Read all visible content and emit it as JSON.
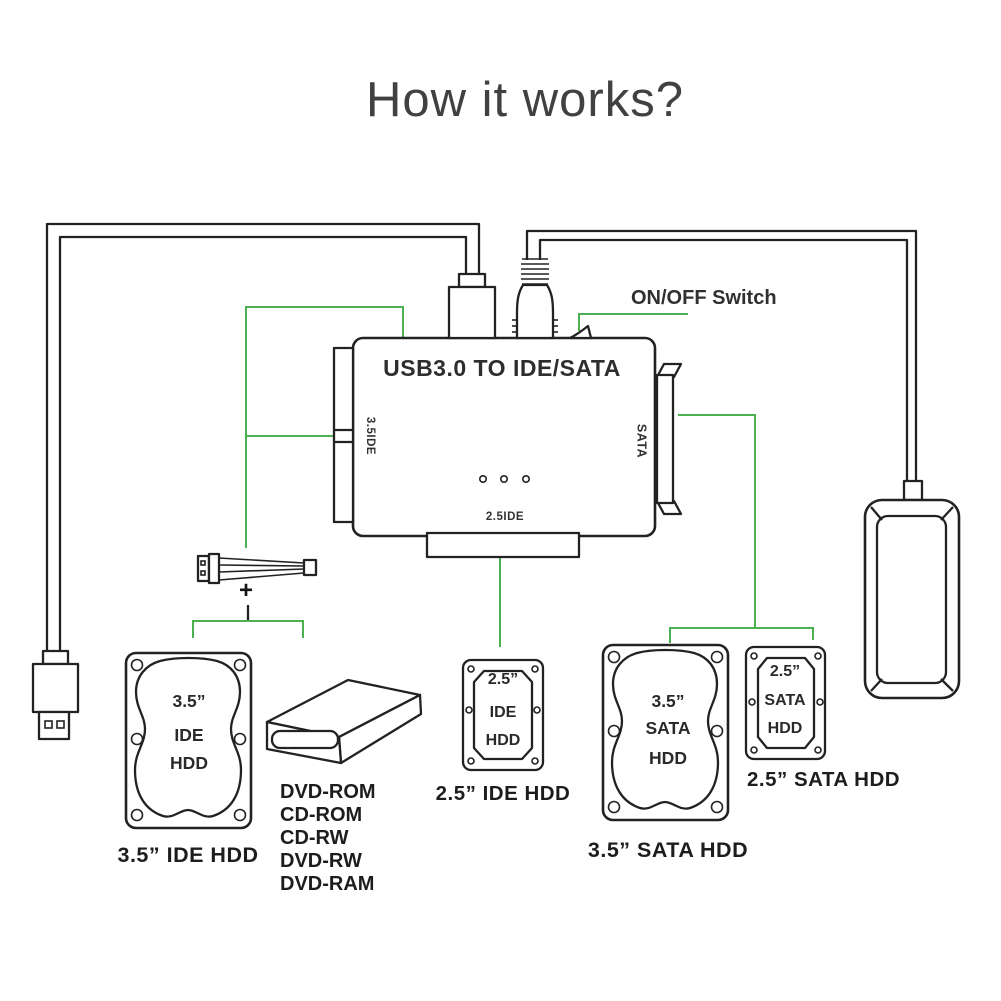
{
  "title": "How it works?",
  "colors": {
    "ink": "#222222",
    "green": "#4CAF50",
    "title_text": "#414141",
    "label_text": "#1d1d1d"
  },
  "adapter": {
    "title": "USB3.0 TO IDE/SATA",
    "left_port_label": "3.5IDE",
    "right_port_label": "SATA",
    "bottom_port_label": "2.5IDE",
    "switch_label": "ON/OFF Switch"
  },
  "power_cable": {
    "plus_label": "+"
  },
  "drives": {
    "ide35": {
      "face": [
        "3.5”",
        "IDE",
        "HDD"
      ],
      "label": "3.5”  IDE HDD"
    },
    "ide25": {
      "face": [
        "2.5”",
        "IDE",
        "HDD"
      ],
      "label": "2.5”  IDE HDD"
    },
    "sata35": {
      "face": [
        "3.5”",
        "SATA",
        "HDD"
      ],
      "label": "3.5”  SATA HDD"
    },
    "sata25": {
      "face": [
        "2.5”",
        "SATA",
        "HDD"
      ],
      "label": "2.5”  SATA HDD"
    },
    "optical": {
      "types": [
        "DVD-ROM",
        "CD-ROM",
        "CD-RW",
        "DVD-RW",
        "DVD-RAM"
      ]
    }
  }
}
